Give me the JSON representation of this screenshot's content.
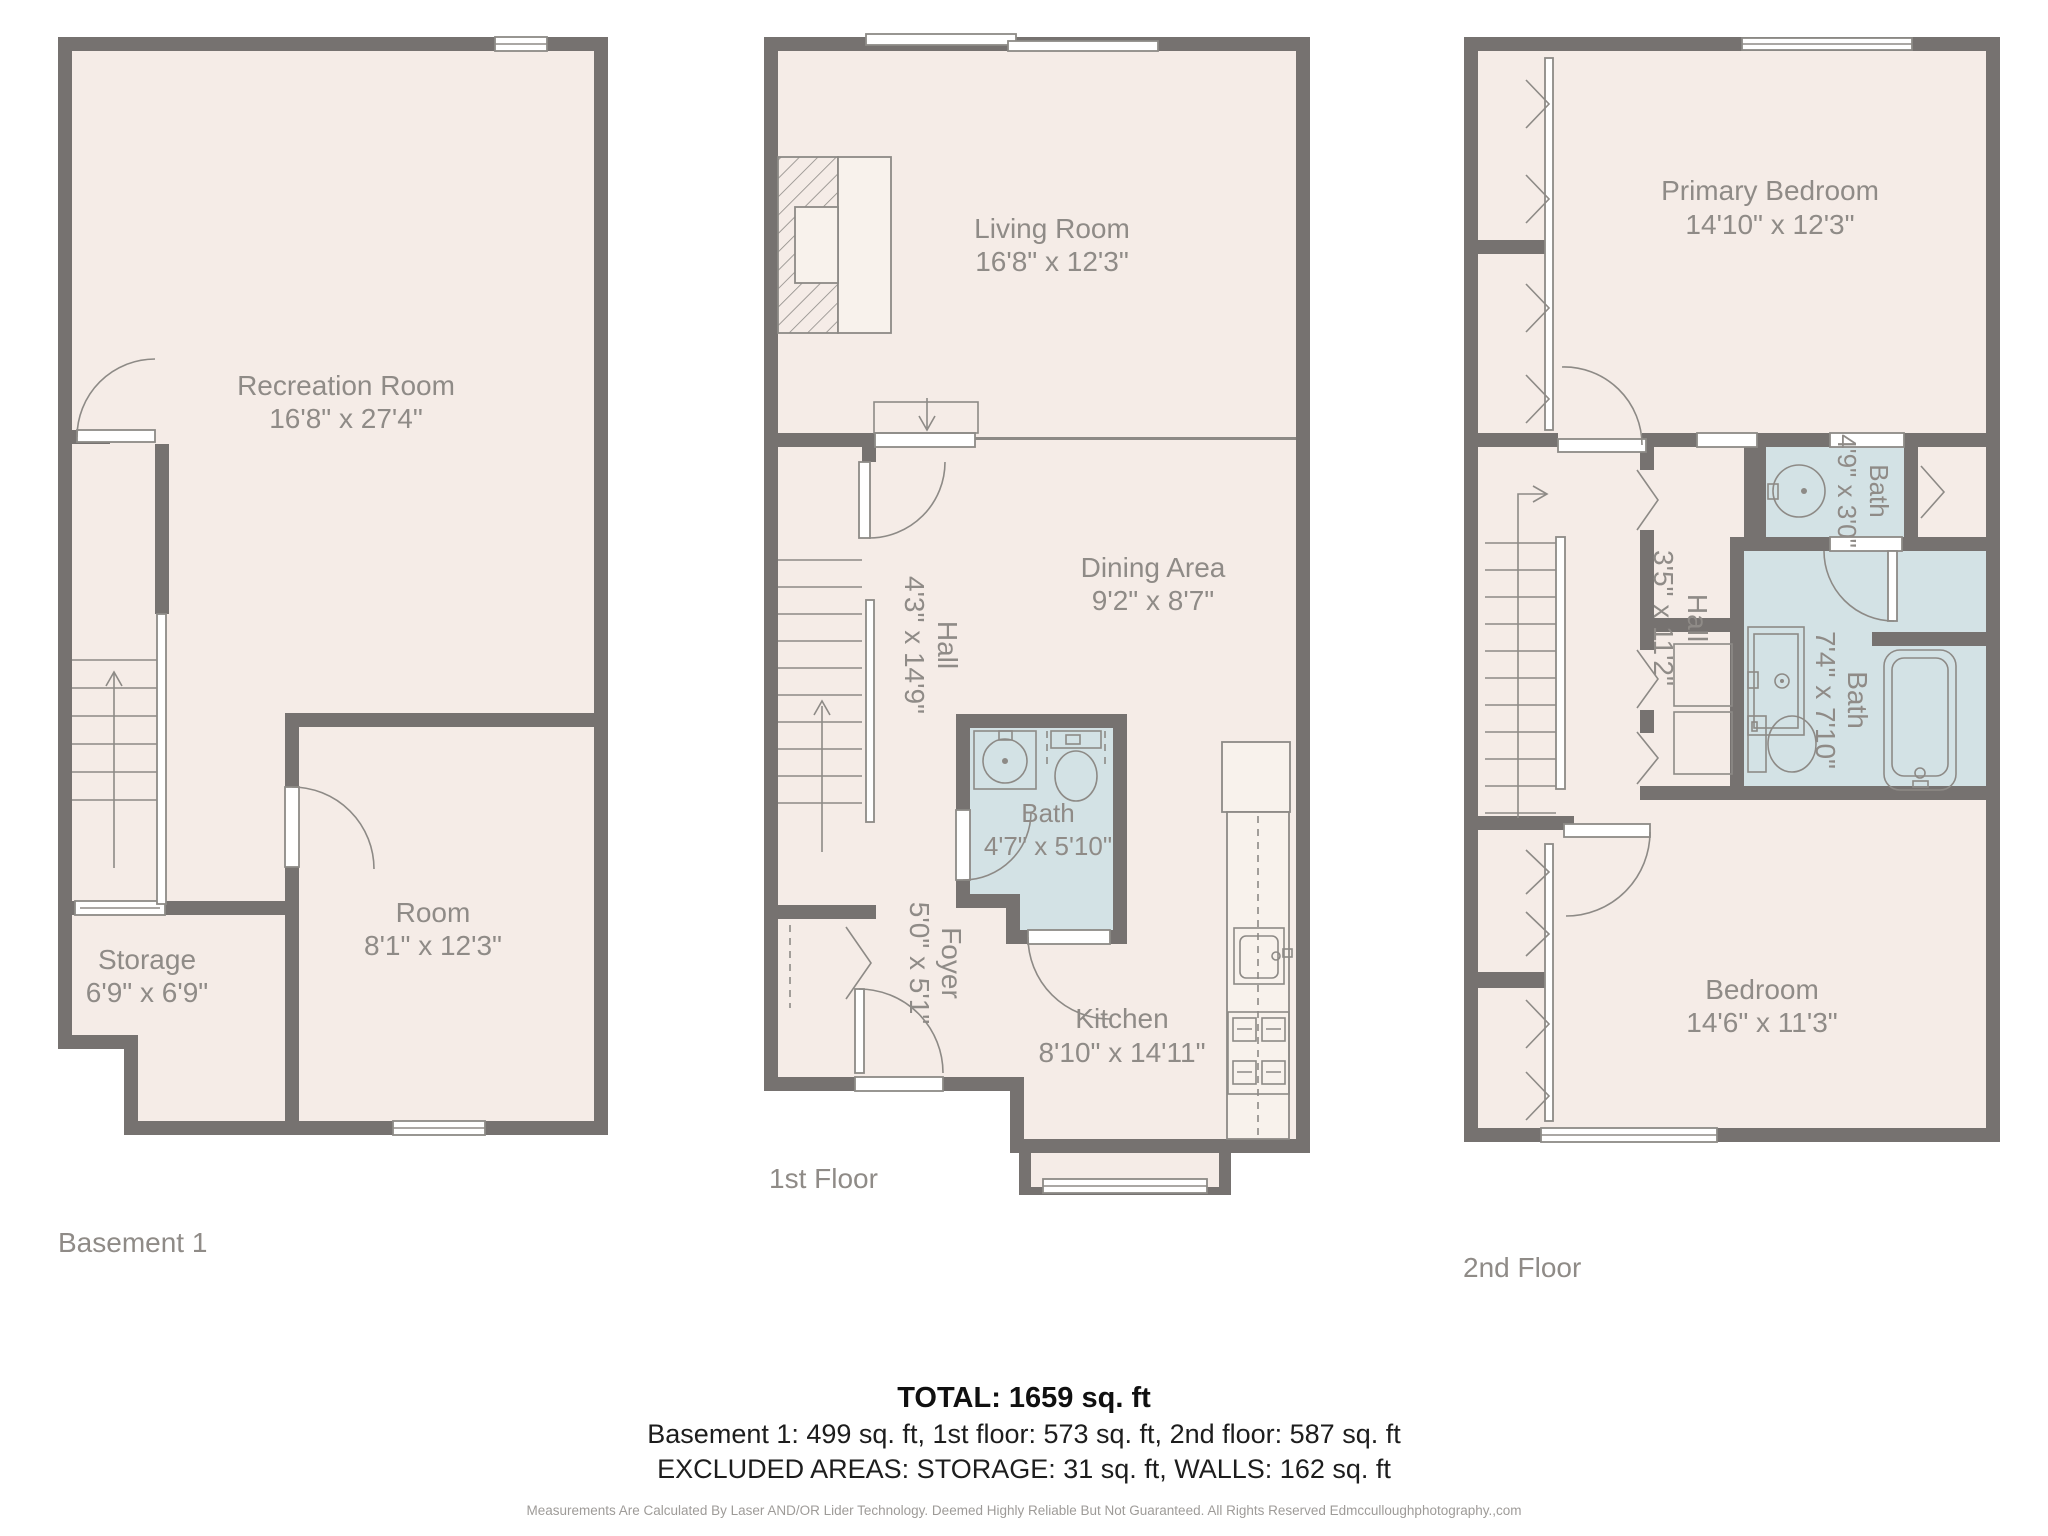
{
  "floors": {
    "basement": {
      "label": "Basement 1",
      "rooms": {
        "recreation": {
          "name": "Recreation Room",
          "dims": "16'8\" x 27'4\""
        },
        "room": {
          "name": "Room",
          "dims": "8'1\" x 12'3\""
        },
        "storage": {
          "name": "Storage",
          "dims": "6'9\" x 6'9\""
        }
      }
    },
    "first": {
      "label": "1st Floor",
      "rooms": {
        "living": {
          "name": "Living Room",
          "dims": "16'8\" x 12'3\""
        },
        "dining": {
          "name": "Dining Area",
          "dims": "9'2\" x 8'7\""
        },
        "hall": {
          "name": "Hall",
          "dims": "4'3\" x 14'9\""
        },
        "bath": {
          "name": "Bath",
          "dims": "4'7\" x 5'10\""
        },
        "foyer": {
          "name": "Foyer",
          "dims": "5'0\" x 5'1\""
        },
        "kitchen": {
          "name": "Kitchen",
          "dims": "8'10\" x 14'11\""
        }
      }
    },
    "second": {
      "label": "2nd Floor",
      "rooms": {
        "primary": {
          "name": "Primary Bedroom",
          "dims": "14'10\" x 12'3\""
        },
        "hall": {
          "name": "Hall",
          "dims": "3'5\" x 11'2\""
        },
        "bath_small": {
          "name": "Bath",
          "dims": "4'9\" x 3'0\""
        },
        "bath_large": {
          "name": "Bath",
          "dims": "7'4\" x 7'10\""
        },
        "bedroom": {
          "name": "Bedroom",
          "dims": "14'6\" x 11'3\""
        }
      }
    }
  },
  "summary": {
    "total": "TOTAL: 1659 sq. ft",
    "floors_line": "Basement 1: 499 sq. ft, 1st floor: 573 sq. ft, 2nd floor: 587 sq. ft",
    "excluded_line": "EXCLUDED AREAS: STORAGE: 31 sq. ft, WALLS: 162 sq. ft",
    "disclaimer": "Measurements Are Calculated By Laser AND/OR Lider Technology. Deemed Highly Reliable But Not Guaranteed. All Rights Reserved Edmcculloughphotography.,com"
  },
  "colors": {
    "wall": "#767270",
    "floor": "#f5ece7",
    "bath": "#d3e2e5",
    "label": "#8f8b87"
  }
}
